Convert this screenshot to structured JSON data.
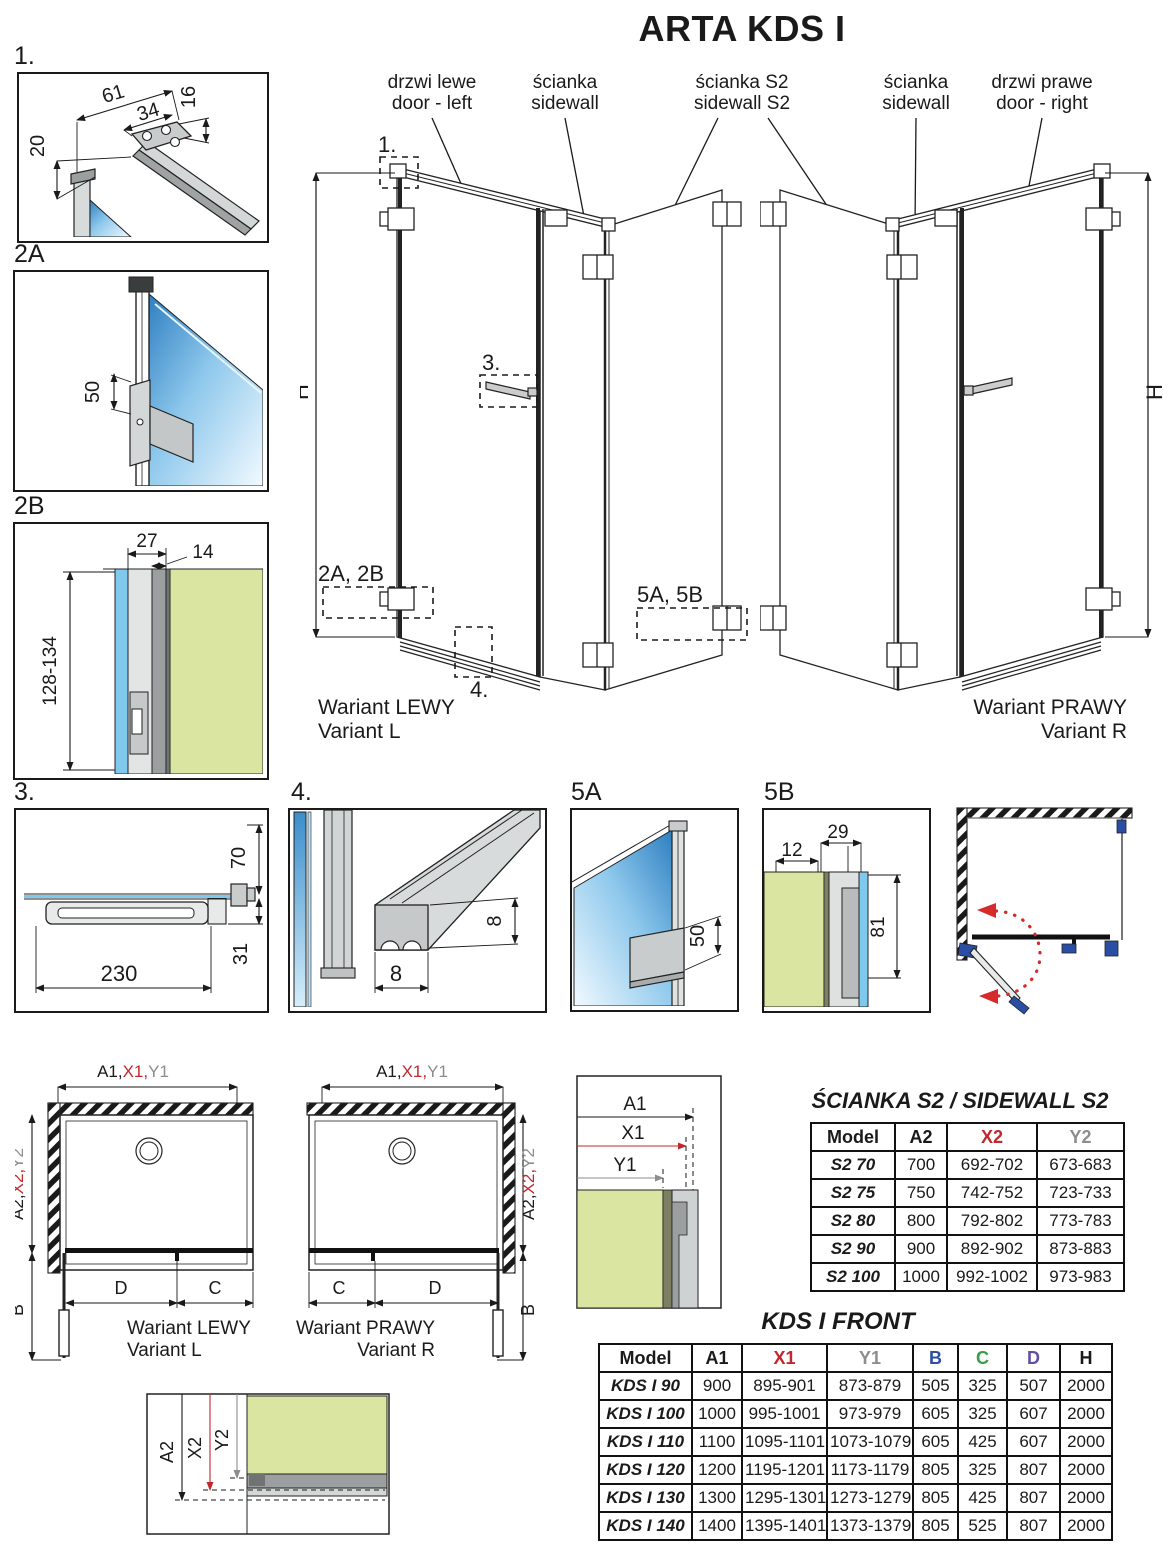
{
  "page": {
    "title": "ARTA KDS I"
  },
  "top_labels": {
    "door_left": {
      "pl": "drzwi lewe",
      "en": "door - left"
    },
    "sidewall_left": {
      "pl": "ścianka",
      "en": "sidewall"
    },
    "sidewall_s2": {
      "pl": "ścianka S2",
      "en": "sidewall S2"
    },
    "sidewall_right": {
      "pl": "ścianka",
      "en": "sidewall"
    },
    "door_right": {
      "pl": "drzwi prawe",
      "en": "door - right"
    }
  },
  "variants": {
    "left": {
      "pl": "Wariant LEWY",
      "en": "Variant L"
    },
    "right": {
      "pl": "Wariant PRAWY",
      "en": "Variant R"
    }
  },
  "callouts": {
    "c1": "1.",
    "c2": "2A, 2B",
    "c3": "3.",
    "c4": "4.",
    "c5": "5A, 5B"
  },
  "dims": {
    "h": "H",
    "d1": {
      "label": "1.",
      "a": "61",
      "b": "34",
      "c": "16",
      "d": "20"
    },
    "d2a": {
      "label": "2A",
      "a": "50"
    },
    "d2b": {
      "label": "2B",
      "a": "27",
      "b": "14",
      "c": "128-134"
    },
    "d3": {
      "label": "3.",
      "a": "70",
      "b": "31",
      "c": "230"
    },
    "d4": {
      "label": "4.",
      "a": "8",
      "b": "8"
    },
    "d5a": {
      "label": "5A",
      "a": "50"
    },
    "d5b": {
      "label": "5B",
      "a": "12",
      "b": "29",
      "c": "81"
    }
  },
  "plan": {
    "front_dim": {
      "a1": "A1,",
      "x1": "X1,",
      "y1": "Y1"
    },
    "side_dim": {
      "a2": "A2,",
      "x2": "X2,",
      "y2": "Y2"
    },
    "b": "B",
    "c": "C",
    "d": "D"
  },
  "section_front": {
    "a1": "A1",
    "x1": "X1",
    "y1": "Y1"
  },
  "section_side": {
    "a2": "A2",
    "x2": "X2",
    "y2": "Y2"
  },
  "s2_table": {
    "title": "ŚCIANKA S2 / SIDEWALL S2",
    "headers": [
      {
        "label": "Model",
        "color": "#1a1a1a"
      },
      {
        "label": "A2",
        "color": "#1a1a1a"
      },
      {
        "label": "X2",
        "color": "#c1272d"
      },
      {
        "label": "Y2",
        "color": "#8d8d8d"
      }
    ],
    "rows": [
      {
        "model": "S2 70",
        "cells": [
          "700",
          "692-702",
          "673-683"
        ]
      },
      {
        "model": "S2 75",
        "cells": [
          "750",
          "742-752",
          "723-733"
        ]
      },
      {
        "model": "S2 80",
        "cells": [
          "800",
          "792-802",
          "773-783"
        ]
      },
      {
        "model": "S2 90",
        "cells": [
          "900",
          "892-902",
          "873-883"
        ]
      },
      {
        "model": "S2 100",
        "cells": [
          "1000",
          "992-1002",
          "973-983"
        ]
      }
    ]
  },
  "front_table": {
    "title": "KDS I FRONT",
    "headers": [
      {
        "label": "Model",
        "color": "#1a1a1a"
      },
      {
        "label": "A1",
        "color": "#1a1a1a"
      },
      {
        "label": "X1",
        "color": "#c1272d"
      },
      {
        "label": "Y1",
        "color": "#8d8d8d"
      },
      {
        "label": "B",
        "color": "#2d4fa2"
      },
      {
        "label": "C",
        "color": "#3b9c45"
      },
      {
        "label": "D",
        "color": "#6150a1"
      },
      {
        "label": "H",
        "color": "#1a1a1a"
      }
    ],
    "rows": [
      {
        "model": "KDS I 90",
        "cells": [
          "900",
          "895-901",
          "873-879",
          "505",
          "325",
          "507",
          "2000"
        ]
      },
      {
        "model": "KDS I 100",
        "cells": [
          "1000",
          "995-1001",
          "973-979",
          "605",
          "325",
          "607",
          "2000"
        ]
      },
      {
        "model": "KDS I 110",
        "cells": [
          "1100",
          "1095-1101",
          "1073-1079",
          "605",
          "425",
          "607",
          "2000"
        ]
      },
      {
        "model": "KDS I 120",
        "cells": [
          "1200",
          "1195-1201",
          "1173-1179",
          "805",
          "325",
          "807",
          "2000"
        ]
      },
      {
        "model": "KDS I 130",
        "cells": [
          "1300",
          "1295-1301",
          "1273-1279",
          "805",
          "425",
          "807",
          "2000"
        ]
      },
      {
        "model": "KDS I 140",
        "cells": [
          "1400",
          "1395-1401",
          "1373-1379",
          "805",
          "525",
          "807",
          "2000"
        ]
      }
    ]
  },
  "colors": {
    "accent_x": "#c1272d",
    "accent_y": "#8d8d8d",
    "accent_b": "#2d4fa2",
    "accent_c": "#3b9c45",
    "accent_d": "#6150a1",
    "glass_blue": "#7fc9ee",
    "green_fill": "#dbe5a2",
    "swing_red": "#d62b2b",
    "hardware_blue": "#2b4ea5"
  }
}
